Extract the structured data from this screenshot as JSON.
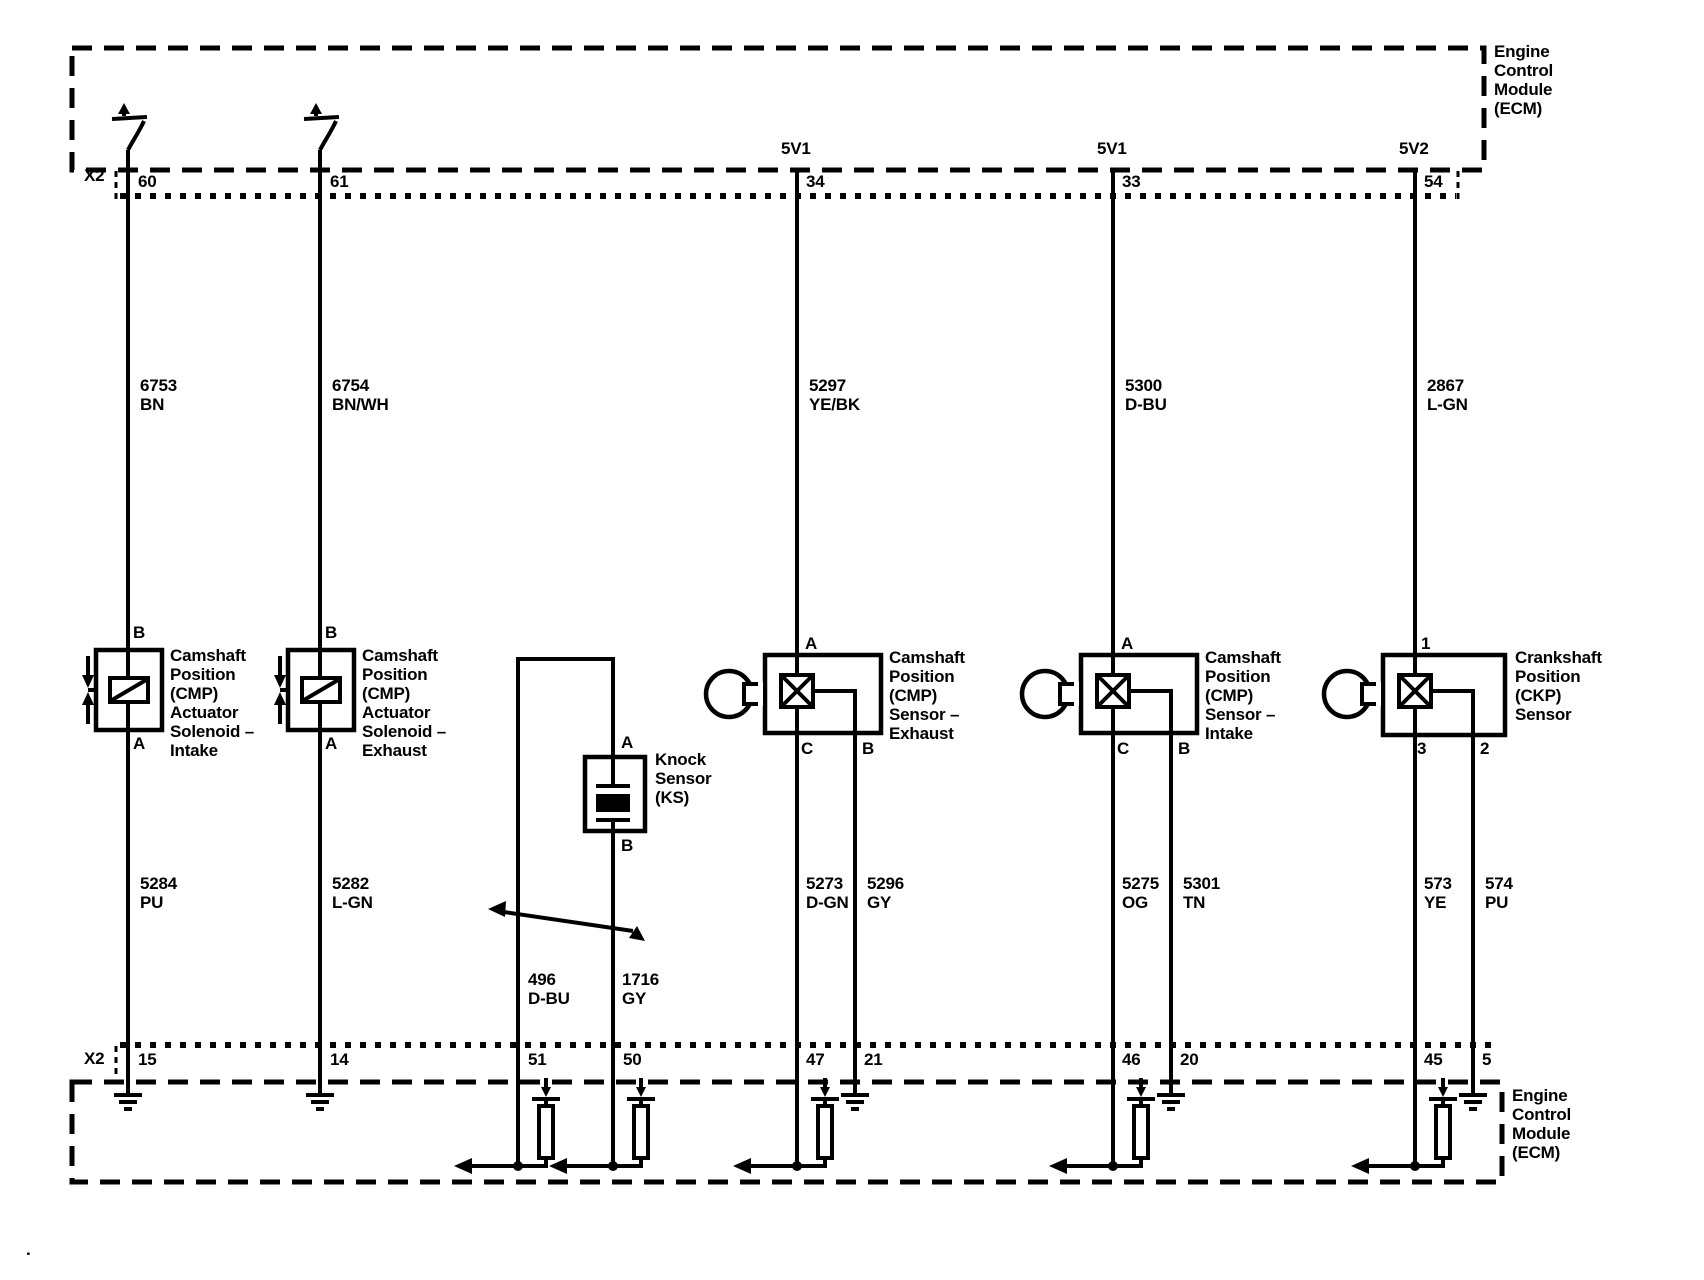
{
  "ecm_top": {
    "label": "Engine\nControl\nModule\n(ECM)",
    "connector_label": "X2",
    "references": {
      "ref_5v1_exhaust": "5V1",
      "ref_5v1_intake": "5V1",
      "ref_5v2": "5V2"
    },
    "pins": {
      "p60": "60",
      "p61": "61",
      "p34": "34",
      "p33": "33",
      "p54": "54"
    }
  },
  "ecm_bottom": {
    "label": "Engine\nControl\nModule\n(ECM)",
    "connector_label": "X2",
    "pins": {
      "p15": "15",
      "p14": "14",
      "p51": "51",
      "p50": "50",
      "p47": "47",
      "p21": "21",
      "p46": "46",
      "p20": "20",
      "p45": "45",
      "p5": "5"
    }
  },
  "wires": {
    "w6753": {
      "circuit": "6753",
      "color": "BN"
    },
    "w6754": {
      "circuit": "6754",
      "color": "BN/WH"
    },
    "w5297": {
      "circuit": "5297",
      "color": "YE/BK"
    },
    "w5300": {
      "circuit": "5300",
      "color": "D-BU"
    },
    "w2867": {
      "circuit": "2867",
      "color": "L-GN"
    },
    "w5284": {
      "circuit": "5284",
      "color": "PU"
    },
    "w5282": {
      "circuit": "5282",
      "color": "L-GN"
    },
    "w496": {
      "circuit": "496",
      "color": "D-BU"
    },
    "w1716": {
      "circuit": "1716",
      "color": "GY"
    },
    "w5273": {
      "circuit": "5273",
      "color": "D-GN"
    },
    "w5296": {
      "circuit": "5296",
      "color": "GY"
    },
    "w5275": {
      "circuit": "5275",
      "color": "OG"
    },
    "w5301": {
      "circuit": "5301",
      "color": "TN"
    },
    "w573": {
      "circuit": "573",
      "color": "YE"
    },
    "w574": {
      "circuit": "574",
      "color": "PU"
    }
  },
  "components": {
    "cmp_actuator_intake": {
      "label": "Camshaft\nPosition\n(CMP)\nActuator\nSolenoid –\nIntake",
      "pin_top": "B",
      "pin_bottom": "A"
    },
    "cmp_actuator_exhaust": {
      "label": "Camshaft\nPosition\n(CMP)\nActuator\nSolenoid –\nExhaust",
      "pin_top": "B",
      "pin_bottom": "A"
    },
    "knock_sensor": {
      "label": "Knock\nSensor\n(KS)",
      "pin_top": "A",
      "pin_bottom": "B"
    },
    "cmp_sensor_exhaust": {
      "label": "Camshaft\nPosition\n(CMP)\nSensor –\nExhaust",
      "pin_a": "A",
      "pin_c": "C",
      "pin_b": "B"
    },
    "cmp_sensor_intake": {
      "label": "Camshaft\nPosition\n(CMP)\nSensor –\nIntake",
      "pin_a": "A",
      "pin_c": "C",
      "pin_b": "B"
    },
    "ckp_sensor": {
      "label": "Crankshaft\nPosition\n(CKP)\nSensor",
      "pin_1": "1",
      "pin_3": "3",
      "pin_2": "2"
    }
  },
  "misc": {
    "stray_dot": "."
  }
}
